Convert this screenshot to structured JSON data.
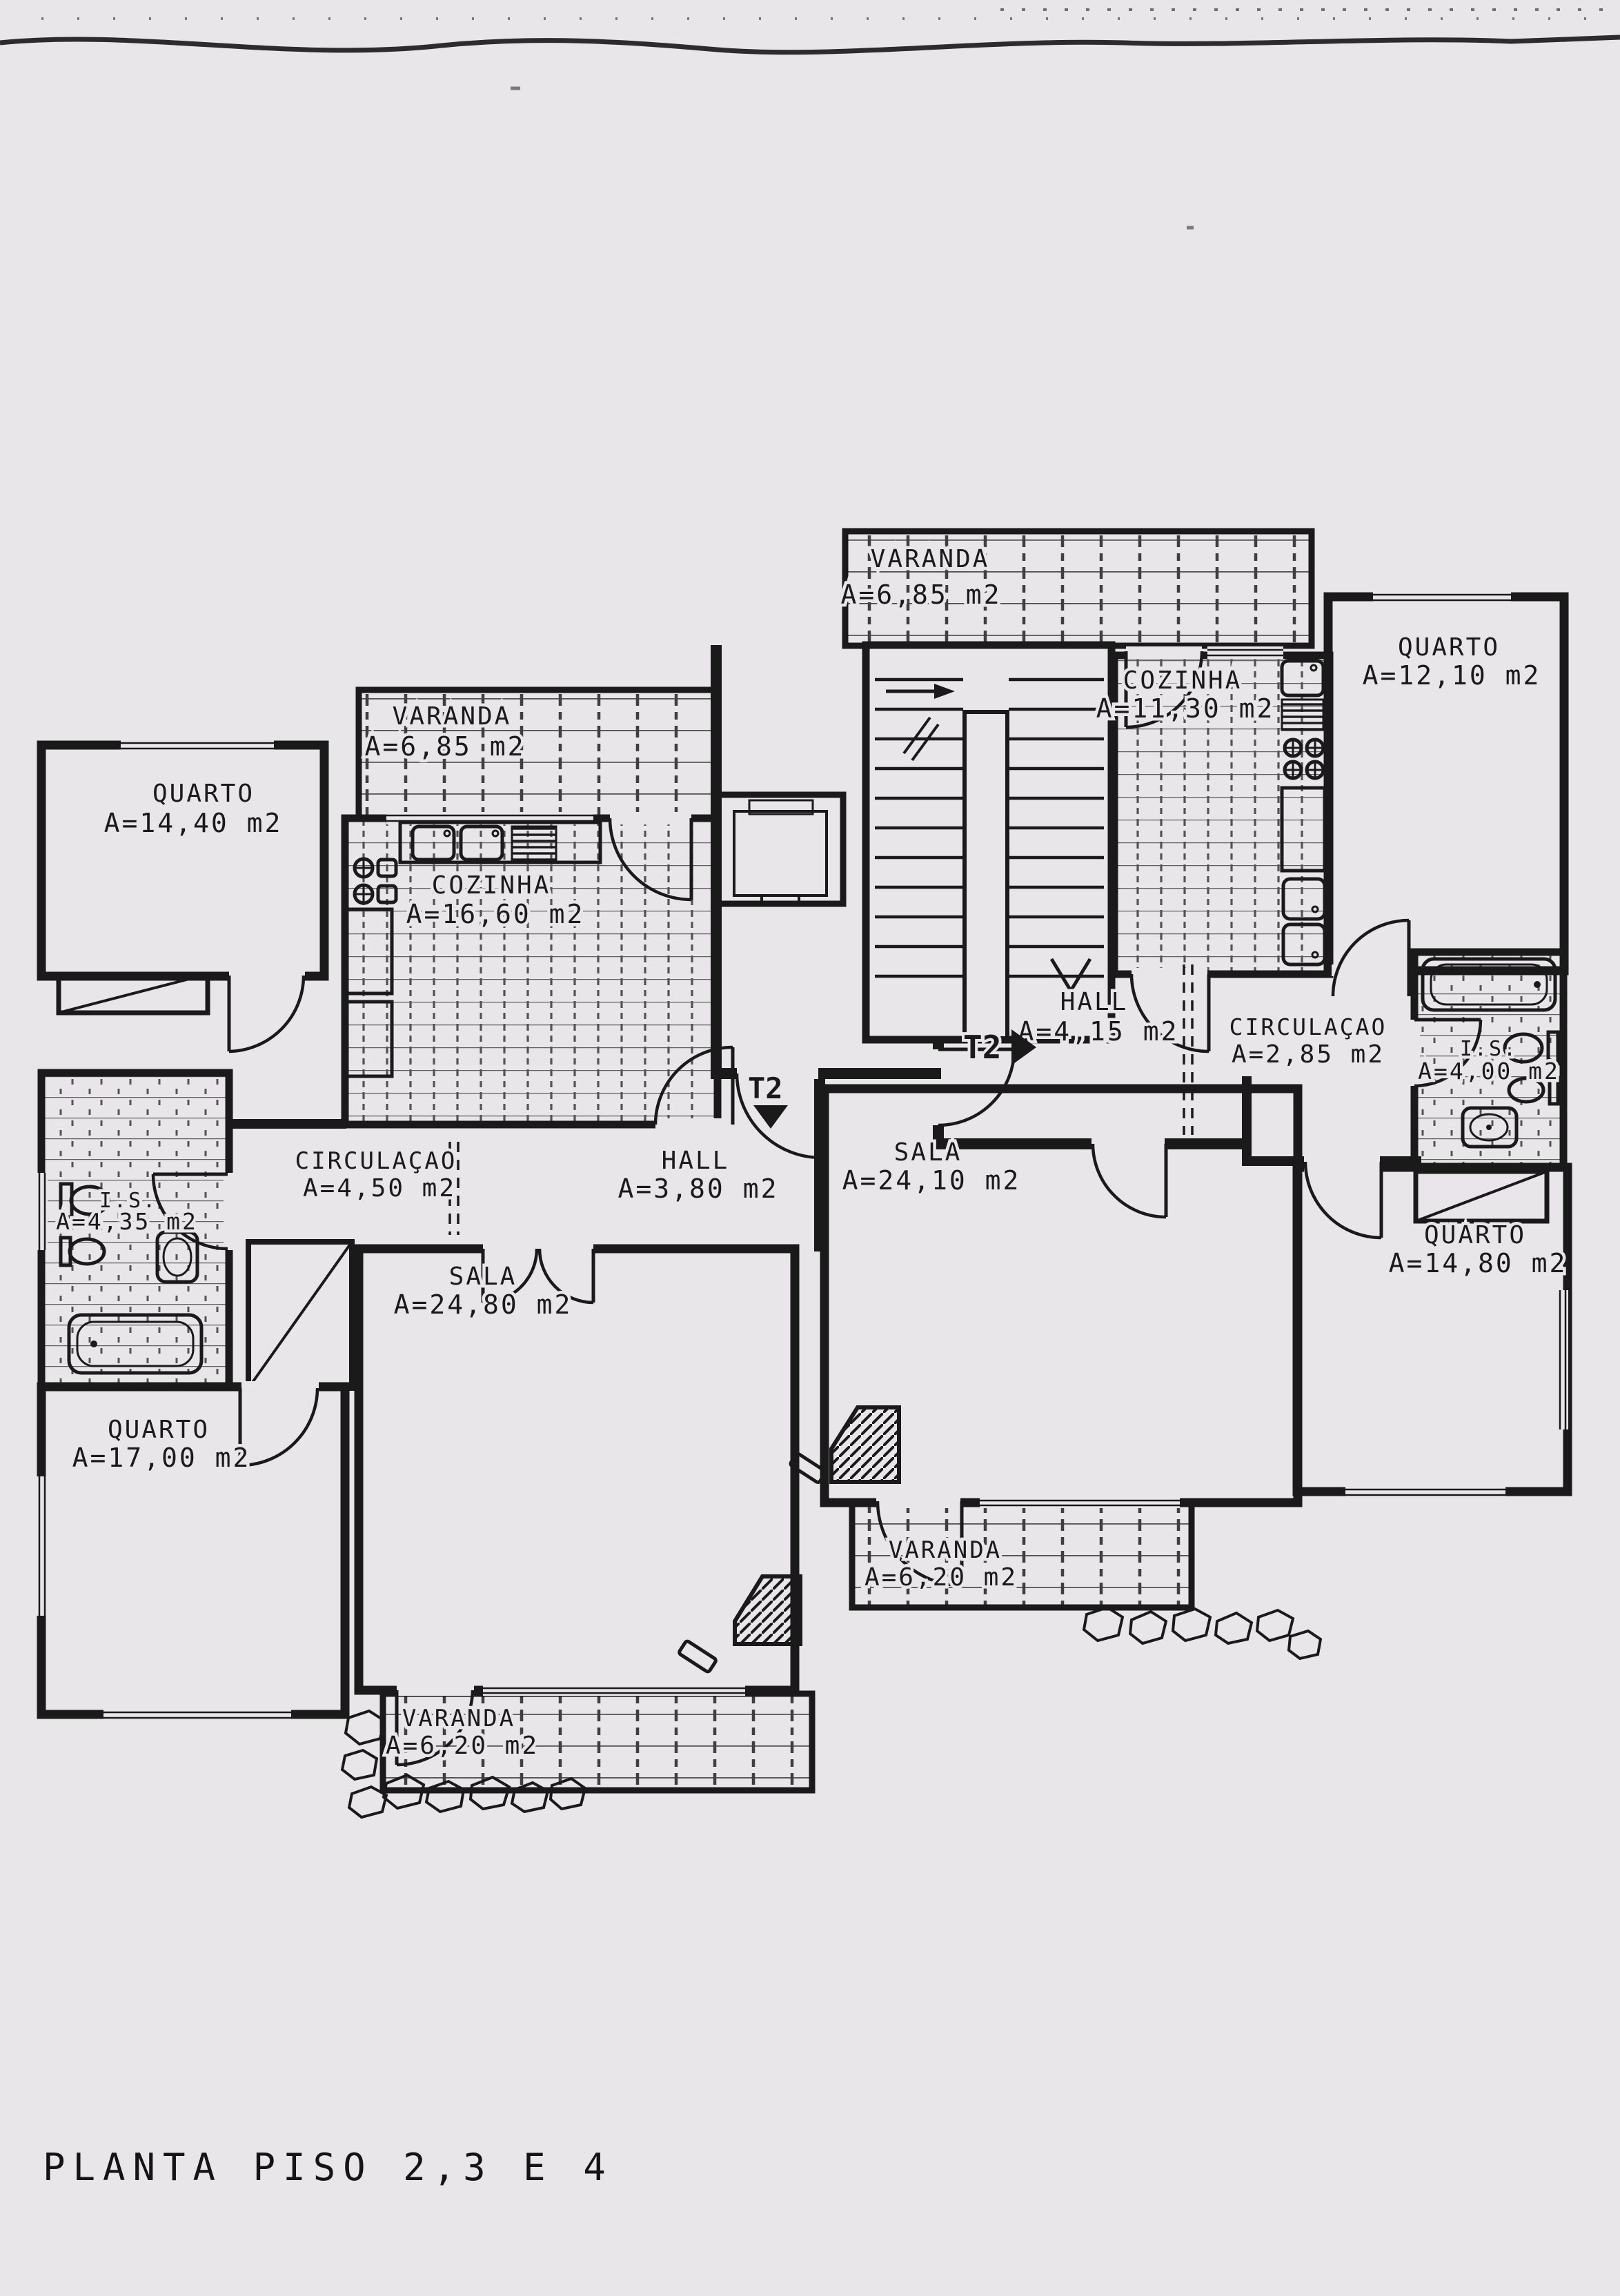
{
  "title": "PLANTA PISO 2,3 E 4",
  "colors": {
    "paper": "#e9e6e9",
    "ink": "#1a1a1a",
    "tile": "#4a4a4a"
  },
  "markers": {
    "unit_right_entry": "T2",
    "unit_left_entry": "T2"
  },
  "rooms": [
    {
      "id": "varanda-top",
      "name": "VARANDA",
      "area": "A=6,85 m2"
    },
    {
      "id": "cozinha-right",
      "name": "COZINHA",
      "area": "A=11,30 m2"
    },
    {
      "id": "quarto-top-right",
      "name": "QUARTO",
      "area": "A=12,10 m2"
    },
    {
      "id": "quarto-left",
      "name": "QUARTO",
      "area": "A=14,40 m2"
    },
    {
      "id": "varanda-left",
      "name": "VARANDA",
      "area": "A=6,85 m2"
    },
    {
      "id": "cozinha-left",
      "name": "COZINHA",
      "area": "A=16,60 m2"
    },
    {
      "id": "hall-right",
      "name": "HALL",
      "area": "A=4,15 m2"
    },
    {
      "id": "circulacao-right",
      "name": "CIRCULAÇAO",
      "area": "A=2,85 m2"
    },
    {
      "id": "is-right",
      "name": "I.S.",
      "area": "A=4,00 m2"
    },
    {
      "id": "sala-right",
      "name": "SALA",
      "area": "A=24,10 m2"
    },
    {
      "id": "circulacao-left",
      "name": "CIRCULAÇAO",
      "area": "A=4,50 m2"
    },
    {
      "id": "hall-left",
      "name": "HALL",
      "area": "A=3,80 m2"
    },
    {
      "id": "sala-left",
      "name": "SALA",
      "area": "A=24,80 m2"
    },
    {
      "id": "is-left",
      "name": "I.S.",
      "area": "A=4,35 m2"
    },
    {
      "id": "quarto-bottom-left",
      "name": "QUARTO",
      "area": "A=17,00 m2"
    },
    {
      "id": "quarto-right",
      "name": "QUARTO",
      "area": "A=14,80 m2"
    },
    {
      "id": "varanda-bottom-left",
      "name": "VARANDA",
      "area": "A=6,20 m2"
    },
    {
      "id": "varanda-bottom-right",
      "name": "VARANDA",
      "area": "A=6,20 m2"
    }
  ]
}
